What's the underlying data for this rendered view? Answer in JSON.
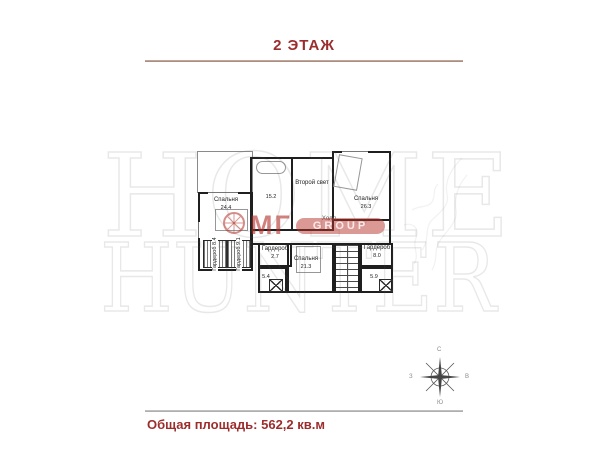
{
  "title": "2 ЭТАЖ",
  "footer": {
    "total_area_label": "Общая площадь: 562,2 кв.м"
  },
  "compass": {
    "north": "С",
    "south": "Ю",
    "west": "З",
    "east": "В"
  },
  "watermark": {
    "line1": "HOME",
    "line2": "HUNTER",
    "brand_initials": "МГ",
    "brand_word": "GROUP"
  },
  "colors": {
    "accent_red": "#9c2d2d",
    "wall_black": "#1f1f1f",
    "brand_red": "#b7342d",
    "separator_top": "#b0917f",
    "separator_bottom": "#b5b5b5"
  },
  "plan": {
    "rooms": [
      {
        "name": "Спальня",
        "area": "24.4"
      },
      {
        "name": "",
        "area": "15.2"
      },
      {
        "name": "Второй свет",
        "area": ""
      },
      {
        "name": "Спальня",
        "area": "26.3"
      },
      {
        "name": "Холл",
        "area": ""
      },
      {
        "name": "Гардероб",
        "area": "8.4"
      },
      {
        "name": "Гардероб",
        "area": "9.1"
      },
      {
        "name": "Гардероб",
        "area": "2.7"
      },
      {
        "name": "Спальня",
        "area": "21.3"
      },
      {
        "name": "",
        "area": "5.4"
      },
      {
        "name": "Гардероб",
        "area": "8.0"
      },
      {
        "name": "",
        "area": "5.9"
      }
    ]
  }
}
